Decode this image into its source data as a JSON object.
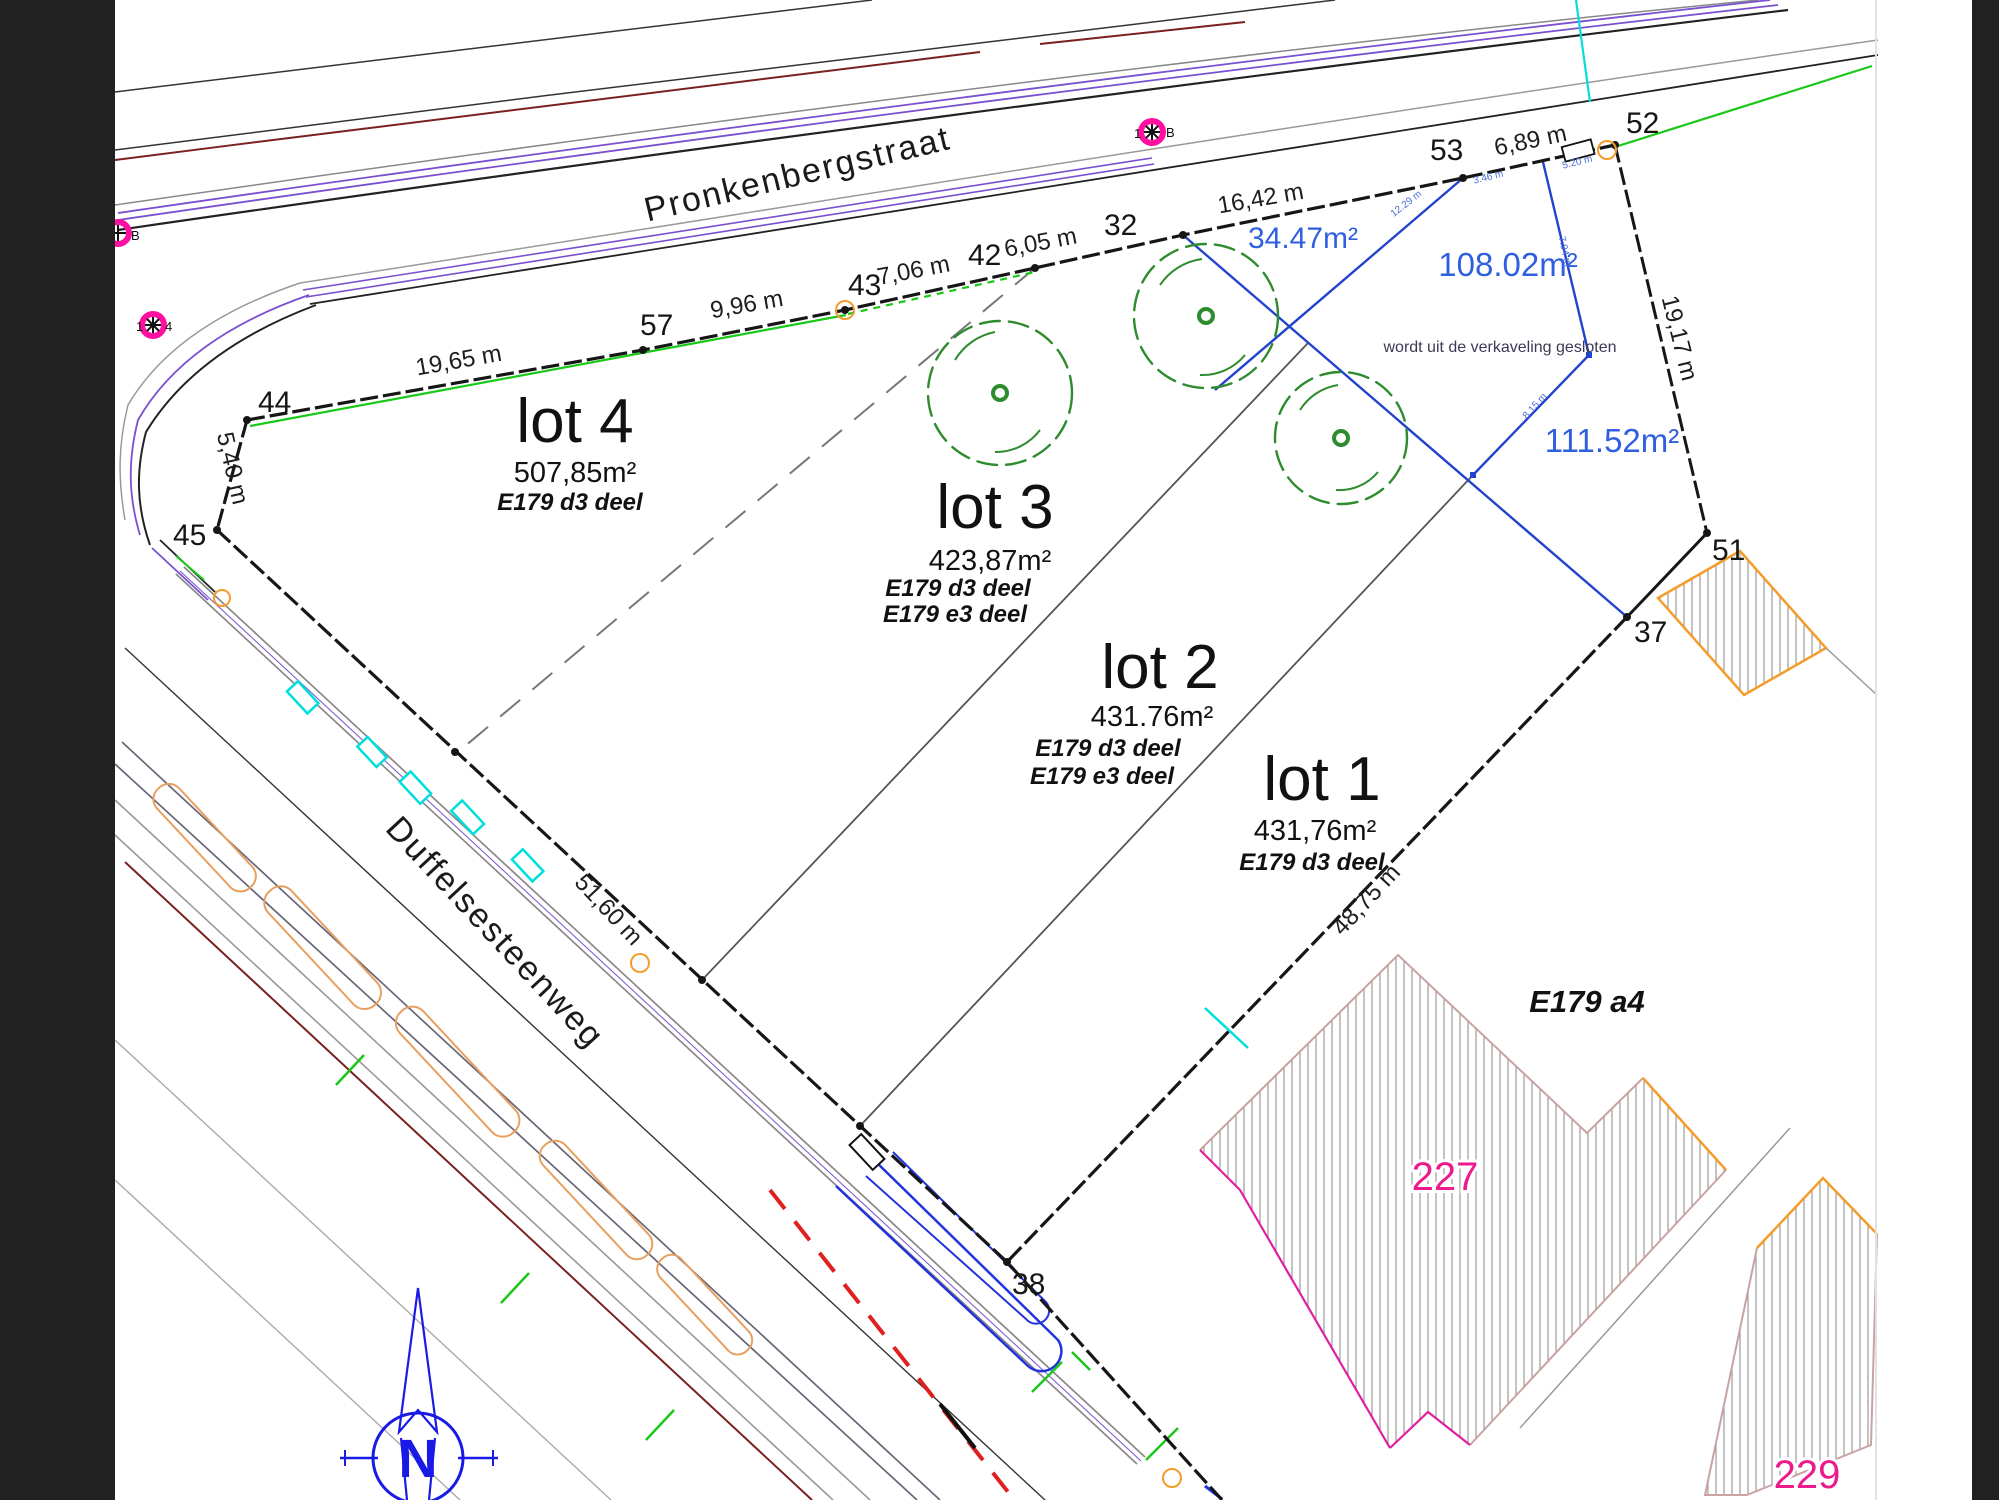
{
  "title": "Verkavelingsplan Pronkenbergstraat / Duffelsesteenweg",
  "streets": {
    "pronkenbergstraat": "Pronkenbergstraat",
    "duffelsesteenweg": "Duffelsesteenweg"
  },
  "lots": [
    {
      "name": "lot 4",
      "area": "507,85m²",
      "parcels": [
        "E179 d3 deel"
      ]
    },
    {
      "name": "lot 3",
      "area": "423,87m²",
      "parcels": [
        "E179 d3 deel",
        "E179 e3 deel"
      ]
    },
    {
      "name": "lot 2",
      "area": "431.76m²",
      "parcels": [
        "E179 d3 deel",
        "E179 e3 deel"
      ]
    },
    {
      "name": "lot 1",
      "area": "431,76m²",
      "parcels": [
        "E179 d3 deel"
      ]
    }
  ],
  "excluded_zone": {
    "note": "wordt uit de verkaveling gesloten",
    "areas": [
      "34.47m²",
      "108.02m²",
      "111.52m²"
    ],
    "sub_measurements": [
      "12.29 m",
      "3.46 m",
      "5.20 m",
      "7.94 m",
      "8.15 m"
    ]
  },
  "points": {
    "p44": "44",
    "p45": "45",
    "p57": "57",
    "p43": "43",
    "p42": "42",
    "p32": "32",
    "p53": "53",
    "p52": "52",
    "p51": "51",
    "p37": "37",
    "p38": "38"
  },
  "measurements": {
    "seg_44_57": "19,65 m",
    "seg_57_43": "9,96 m",
    "seg_43_42": "7,06 m",
    "seg_42_32": "6,05 m",
    "seg_32_53": "16,42 m",
    "seg_53_52": "6,89 m",
    "seg_52_51": "19,17 m",
    "seg_44_45": "5,40 m",
    "road_frontage": "51,60 m",
    "seg_37_38": "48,75 m"
  },
  "neighbours": {
    "e179a4": "E179 a4",
    "n227": "227",
    "n229": "229"
  },
  "markers": {
    "top_prefix": "1",
    "top_suffix": "B",
    "left_suffix": "B",
    "lower_left_prefix": "1",
    "lower_left_suffix": "4"
  },
  "compass": {
    "n": "N"
  },
  "colors": {
    "boundary": "#161616",
    "subdivision_blue": "#2244cc",
    "blue_text": "#2f5fe0",
    "tree_green": "#2e8b2e",
    "marking_green": "#19c819",
    "cyan": "#00dede",
    "orange": "#f49c2c",
    "magenta_label": "#ec1a8c",
    "marker_magenta": "#ff10a0",
    "road_purple": "#7a4fd0",
    "maroon": "#7a2020",
    "red": "#e02020",
    "compass_blue": "#1a1ae6",
    "hatch_gray": "#9a9a9a"
  }
}
